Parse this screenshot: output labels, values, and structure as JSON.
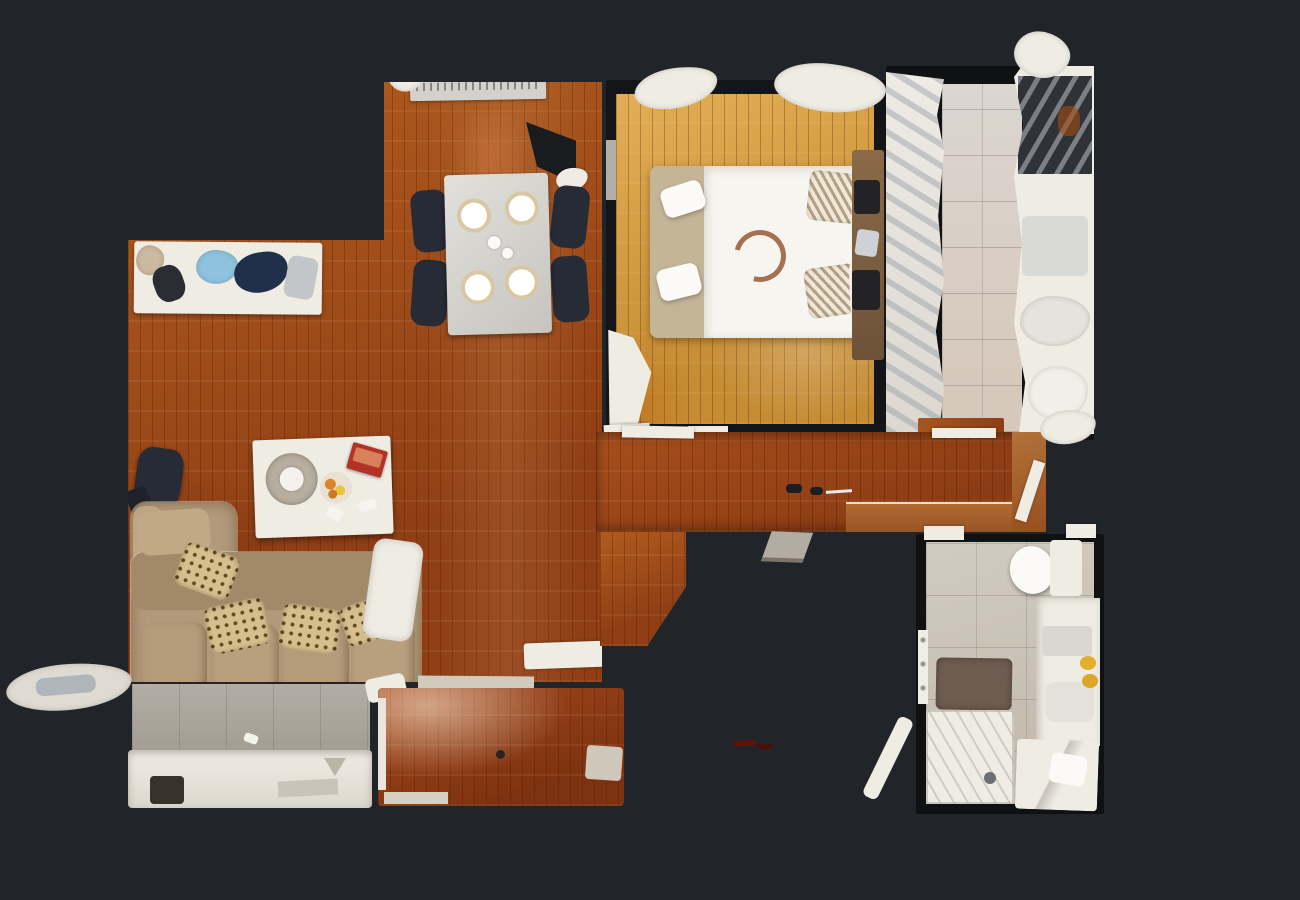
{
  "scene": {
    "type": "3d-dollhouse-floorplan-scan",
    "description": "Top-down 3D dollhouse scan of a one-bedroom apartment floor plan on a dark background",
    "visible_text": ""
  },
  "colors": {
    "background": "#212429",
    "wall_dark": "#131519",
    "living_wood_a": "#b05c1f",
    "living_wood_b": "#8e3d14",
    "bedroom_wood_a": "#e2ae55",
    "bedroom_wood_b": "#c58c33",
    "hall_wood_a": "#a84e1c",
    "hall_wood_b": "#8c3c14",
    "room_wood_a": "#a64a1a",
    "room_wood_b": "#7e3310",
    "kitchen_tile": "#d6d0ca",
    "bath_tile": "#c8c0b2",
    "balcony_tile": "#aaa49a",
    "sofa": "#b19a7a",
    "sofa_dark": "#a18a68",
    "cream": "#efece4",
    "duvet": "#f7f5f0",
    "blanket": "#c4b597",
    "bath_mat": "#6f5d51",
    "towel_yellow": "#e4af2d",
    "red_book": "#b23326",
    "dark_item": "#262b36",
    "chrome": "#ced1d5",
    "table_white": "#dedcd7"
  },
  "rooms": [
    {
      "label": "Living and dining room",
      "floor": "red-brown parquet",
      "furniture": [
        "dining table with four place settings",
        "four dark chairs",
        "radiator",
        "wall AC unit",
        "white sideboard with objects",
        "L-shaped beige sofa",
        "leopard-print throw pillows",
        "white coffee table",
        "tray with teapot",
        "fruit plate",
        "red book",
        "dark chair",
        "window ledge"
      ]
    },
    {
      "label": "Bedroom",
      "floor": "golden parquet",
      "furniture": [
        "double bed with white duvet",
        "beige runner blanket",
        "two folded white towels",
        "round wall-art motif on bed",
        "two zigzag pillows",
        "white pillows",
        "wooden headboard with nightstands",
        "open door leaf"
      ]
    },
    {
      "label": "Kitchen",
      "floor": "light grey tile",
      "furniture": [
        "left counter run",
        "right counter run",
        "dark appliance block",
        "wood threshold"
      ]
    },
    {
      "label": "Hallway",
      "floor": "red-brown parquet",
      "furniture": [
        "floor knobs",
        "door leaf artifact",
        "lighter threshold panel"
      ]
    },
    {
      "label": "Bathroom",
      "floor": "beige tile",
      "furniture": [
        "toilet",
        "vanity with yellow towels",
        "brown bath mat",
        "shower",
        "bathtub fixture",
        "towel rail"
      ]
    },
    {
      "label": "Balcony terrace",
      "floor": "grey tile",
      "furniture": [
        "white railing ledge",
        "small white object"
      ]
    },
    {
      "label": "Second room",
      "floor": "glossy red-brown parquet",
      "furniture": [
        "door leaf",
        "threshold strip"
      ]
    }
  ]
}
